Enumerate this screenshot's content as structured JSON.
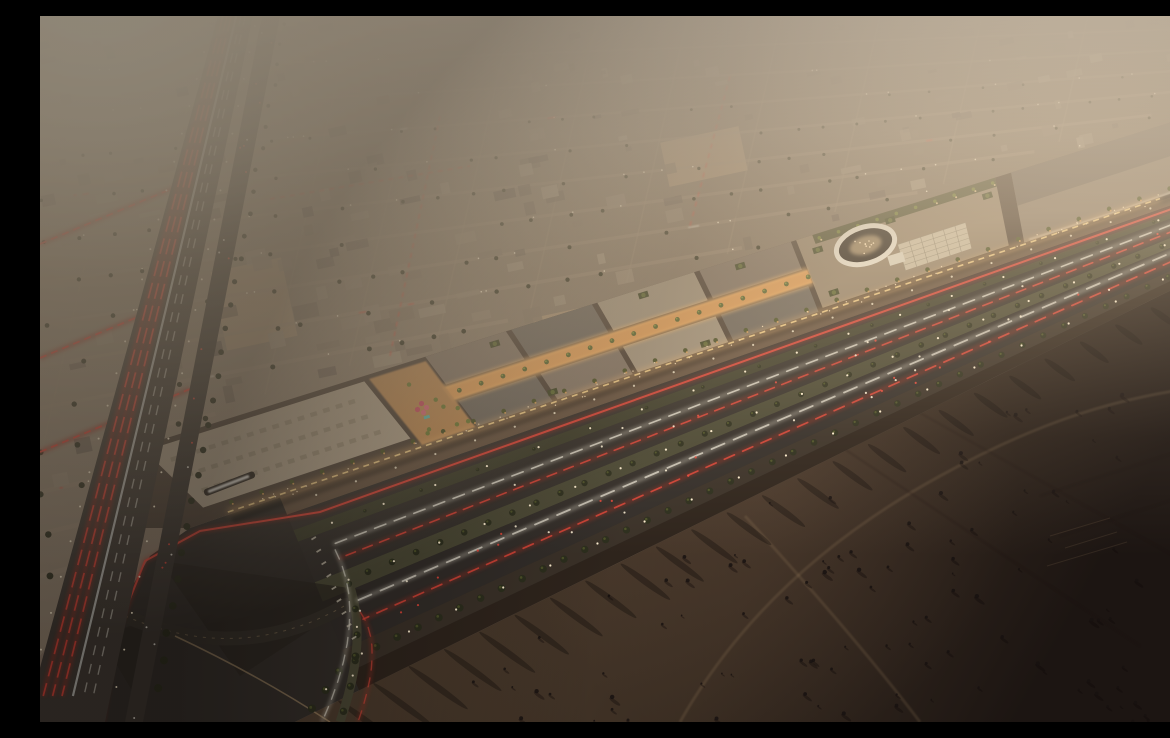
{
  "meta": {
    "description": "Aerial dusk rendering: an illuminated open-air shopping mall strip with rooftop gardens and an oval amphitheater courtyard, set along a palm-lined multi-lane boulevard. A dense low-rise desert city grid stretches into warm haze at top-left; a highway with red tail-light streaks runs down the left; dark empty desert with tire tracks fills the lower right.",
    "canvas": {
      "width": 1170,
      "height": 706
    }
  },
  "palette": {
    "base": "#8c7a68",
    "city_ground": "#83745f",
    "street": "#a4907a",
    "roof_a": "#9b8a76",
    "roof_b": "#8a7a68",
    "roof_c": "#7b6d5e",
    "roof_d": "#6e6156",
    "roof_e": "#a5957f",
    "sand_lot": "#b09678",
    "palm_dark": "#2c2e1d",
    "palm_lit": "#6f7a36",
    "haze_top": "#f1e0c7",
    "sun_glow": "#fff3d8",
    "asphalt": "#332e29",
    "asphalt_light": "#3b3530",
    "median_green": "#4a4834",
    "median_dark": "#3f3e2c",
    "taillight": "#e8473a",
    "taillight_glow": "#a52e22",
    "headlight": "#efe9da",
    "headlight_glow": "#cfc9b8",
    "streetlight": "#ffe2ae",
    "streetlight_core": "#fff0d2",
    "mall_wall": "#4e4136",
    "parking_roof": "#b0a089",
    "roof_mid": "#837465",
    "roof_dark": "#6e665c",
    "roof_light": "#a2937d",
    "roof_tan": "#96846d",
    "anchor_dark": "#5d564e",
    "anchor_light": "#8a7b6a",
    "spine_glow": "#f0a85c",
    "storefront_glow": "#ffbf72",
    "frontage_walk": "#6b5742",
    "oval_ring": "#eae2d2",
    "oval_pit": "#2f2821",
    "skylight": "#cdc1a9",
    "skylight_grid": "#8f8470",
    "planter_green": "#3f4426",
    "umbrella_pink": "#d96a77",
    "pool_teal": "#58b8ae",
    "people": "#ffe4bb",
    "desert_near": "#514030",
    "desert_mid": "#3a2d22",
    "desert_far": "#1c1512",
    "dust": "#826450",
    "track_light": "#c9a87a",
    "track_dark": "#140f0b",
    "sign_white": "#f5f2ea",
    "kerb_light": "#c9a87a",
    "vignette": "#0a0706"
  },
  "geometry": {
    "mall_nw_edge": [
      [
        95,
        432
      ],
      [
        1170,
        94
      ]
    ],
    "mall_frontage": [
      [
        170,
        505
      ],
      [
        1170,
        168
      ]
    ],
    "desert_edge": [
      [
        255,
        706
      ],
      [
        1170,
        255
      ]
    ],
    "highway": {
      "left_top": 178,
      "left_slope": -0.2731,
      "right_top": 213,
      "right_slope": -0.2096,
      "service_left_top": 222,
      "service_right_top": 240,
      "service_slope": -0.194
    },
    "boulevard_bands": {
      "frontage_walk": [
        0.0,
        0.09
      ],
      "frontage_road": [
        0.09,
        0.17
      ],
      "median1": [
        0.17,
        0.23
      ],
      "carriageway_a": [
        0.23,
        0.44
      ],
      "median2": [
        0.44,
        0.54
      ],
      "carriageway_b": [
        0.54,
        0.79
      ],
      "outer_row": [
        0.79,
        0.9
      ],
      "shoulder": [
        0.9,
        1.0
      ]
    },
    "streaks": {
      "carr_a_white": 0.3,
      "carr_a_red": 0.375,
      "carr_b_white": 0.6,
      "carr_b_red": 0.695,
      "frontage_red": 0.13
    },
    "median1_f": 0.2,
    "median2_f": 0.49,
    "outer_f": 0.845,
    "frontage_light_f": 0.045,
    "mall_blocks": [
      {
        "name": "parking-deck",
        "s": [
          0.005,
          0.21
        ],
        "f": [
          0.06,
          0.84
        ],
        "color": "parking_roof"
      },
      {
        "name": "retail-nw-1",
        "s": [
          0.27,
          0.345
        ],
        "f": [
          0.0,
          0.38
        ],
        "color": "roof_mid"
      },
      {
        "name": "retail-nw-2",
        "s": [
          0.35,
          0.425
        ],
        "f": [
          0.0,
          0.38
        ],
        "color": "roof_dark"
      },
      {
        "name": "retail-nw-3",
        "s": [
          0.43,
          0.52
        ],
        "f": [
          0.0,
          0.38
        ],
        "color": "roof_light"
      },
      {
        "name": "retail-nw-4",
        "s": [
          0.525,
          0.61
        ],
        "f": [
          0.0,
          0.38
        ],
        "color": "roof_mid"
      },
      {
        "name": "retail-se-1",
        "s": [
          0.27,
          0.345
        ],
        "f": [
          0.6,
          0.95
        ],
        "color": "roof_dark"
      },
      {
        "name": "retail-se-2",
        "s": [
          0.35,
          0.425
        ],
        "f": [
          0.6,
          0.95
        ],
        "color": "roof_mid"
      },
      {
        "name": "retail-se-3",
        "s": [
          0.43,
          0.52
        ],
        "f": [
          0.6,
          0.95
        ],
        "color": "roof_light"
      },
      {
        "name": "retail-se-4",
        "s": [
          0.525,
          0.61
        ],
        "f": [
          0.6,
          0.95
        ],
        "color": "roof_dark"
      },
      {
        "name": "oval-block",
        "s": [
          0.615,
          0.8
        ],
        "f": [
          0.0,
          0.92
        ],
        "color": "roof_tan"
      },
      {
        "name": "anchor-store",
        "s": [
          0.815,
          0.995
        ],
        "f": [
          0.0,
          0.95
        ],
        "color": "anchor_light"
      }
    ],
    "plaza": {
      "s": [
        0.215,
        0.268
      ],
      "f": [
        0.05,
        0.95
      ]
    },
    "spine": {
      "s": [
        0.265,
        0.615
      ],
      "f": [
        0.4,
        0.58
      ]
    },
    "garden_strip": {
      "s": [
        0.63,
        0.8
      ],
      "f": [
        0.0,
        0.12
      ]
    },
    "oval": {
      "s": 0.672,
      "f": 0.33,
      "rx": 30,
      "ry": 18,
      "rot": -18
    },
    "skylight": {
      "s": [
        0.7,
        0.765
      ],
      "f": [
        0.45,
        0.8
      ]
    },
    "sign": {
      "x": 163,
      "y": 474,
      "w": 54,
      "h": 7,
      "rot": -21
    },
    "sand_lots": [
      [
        178,
        248,
        72,
        80
      ],
      [
        498,
        292,
        90,
        62
      ],
      [
        624,
        118,
        80,
        45
      ]
    ],
    "cross_streets_left": [
      [
        0,
        228
      ],
      [
        0,
        342
      ],
      [
        0,
        436
      ]
    ],
    "desert_tracks": [
      "M 705,500 C 760,560 830,640 880,706",
      "M 640,706 C 700,600 790,520 900,460 C 1000,405 1080,380 1170,370",
      "M 850,380 L 1170,560",
      "M 800,430 L 1100,630",
      "M 1000,480 L 1150,432",
      "M 1020,520 L 1160,475"
    ],
    "interchange": {
      "red_loop_tail": [
        [
          280,
          496
        ],
        [
          160,
          515
        ],
        [
          105,
          545
        ],
        [
          75,
          620
        ],
        [
          62,
          706
        ]
      ],
      "ramp": [
        [
          85,
          600
        ],
        [
          200,
          650
        ],
        [
          306,
          589
        ]
      ],
      "median2_tail_ctrl": [
        330,
        620
      ],
      "median2_tail_end": [
        300,
        706
      ],
      "outer_tail_ctrl": [
        285,
        675
      ],
      "outer_tail_end": [
        262,
        706
      ],
      "crosswalk_t": 0.085
    }
  }
}
